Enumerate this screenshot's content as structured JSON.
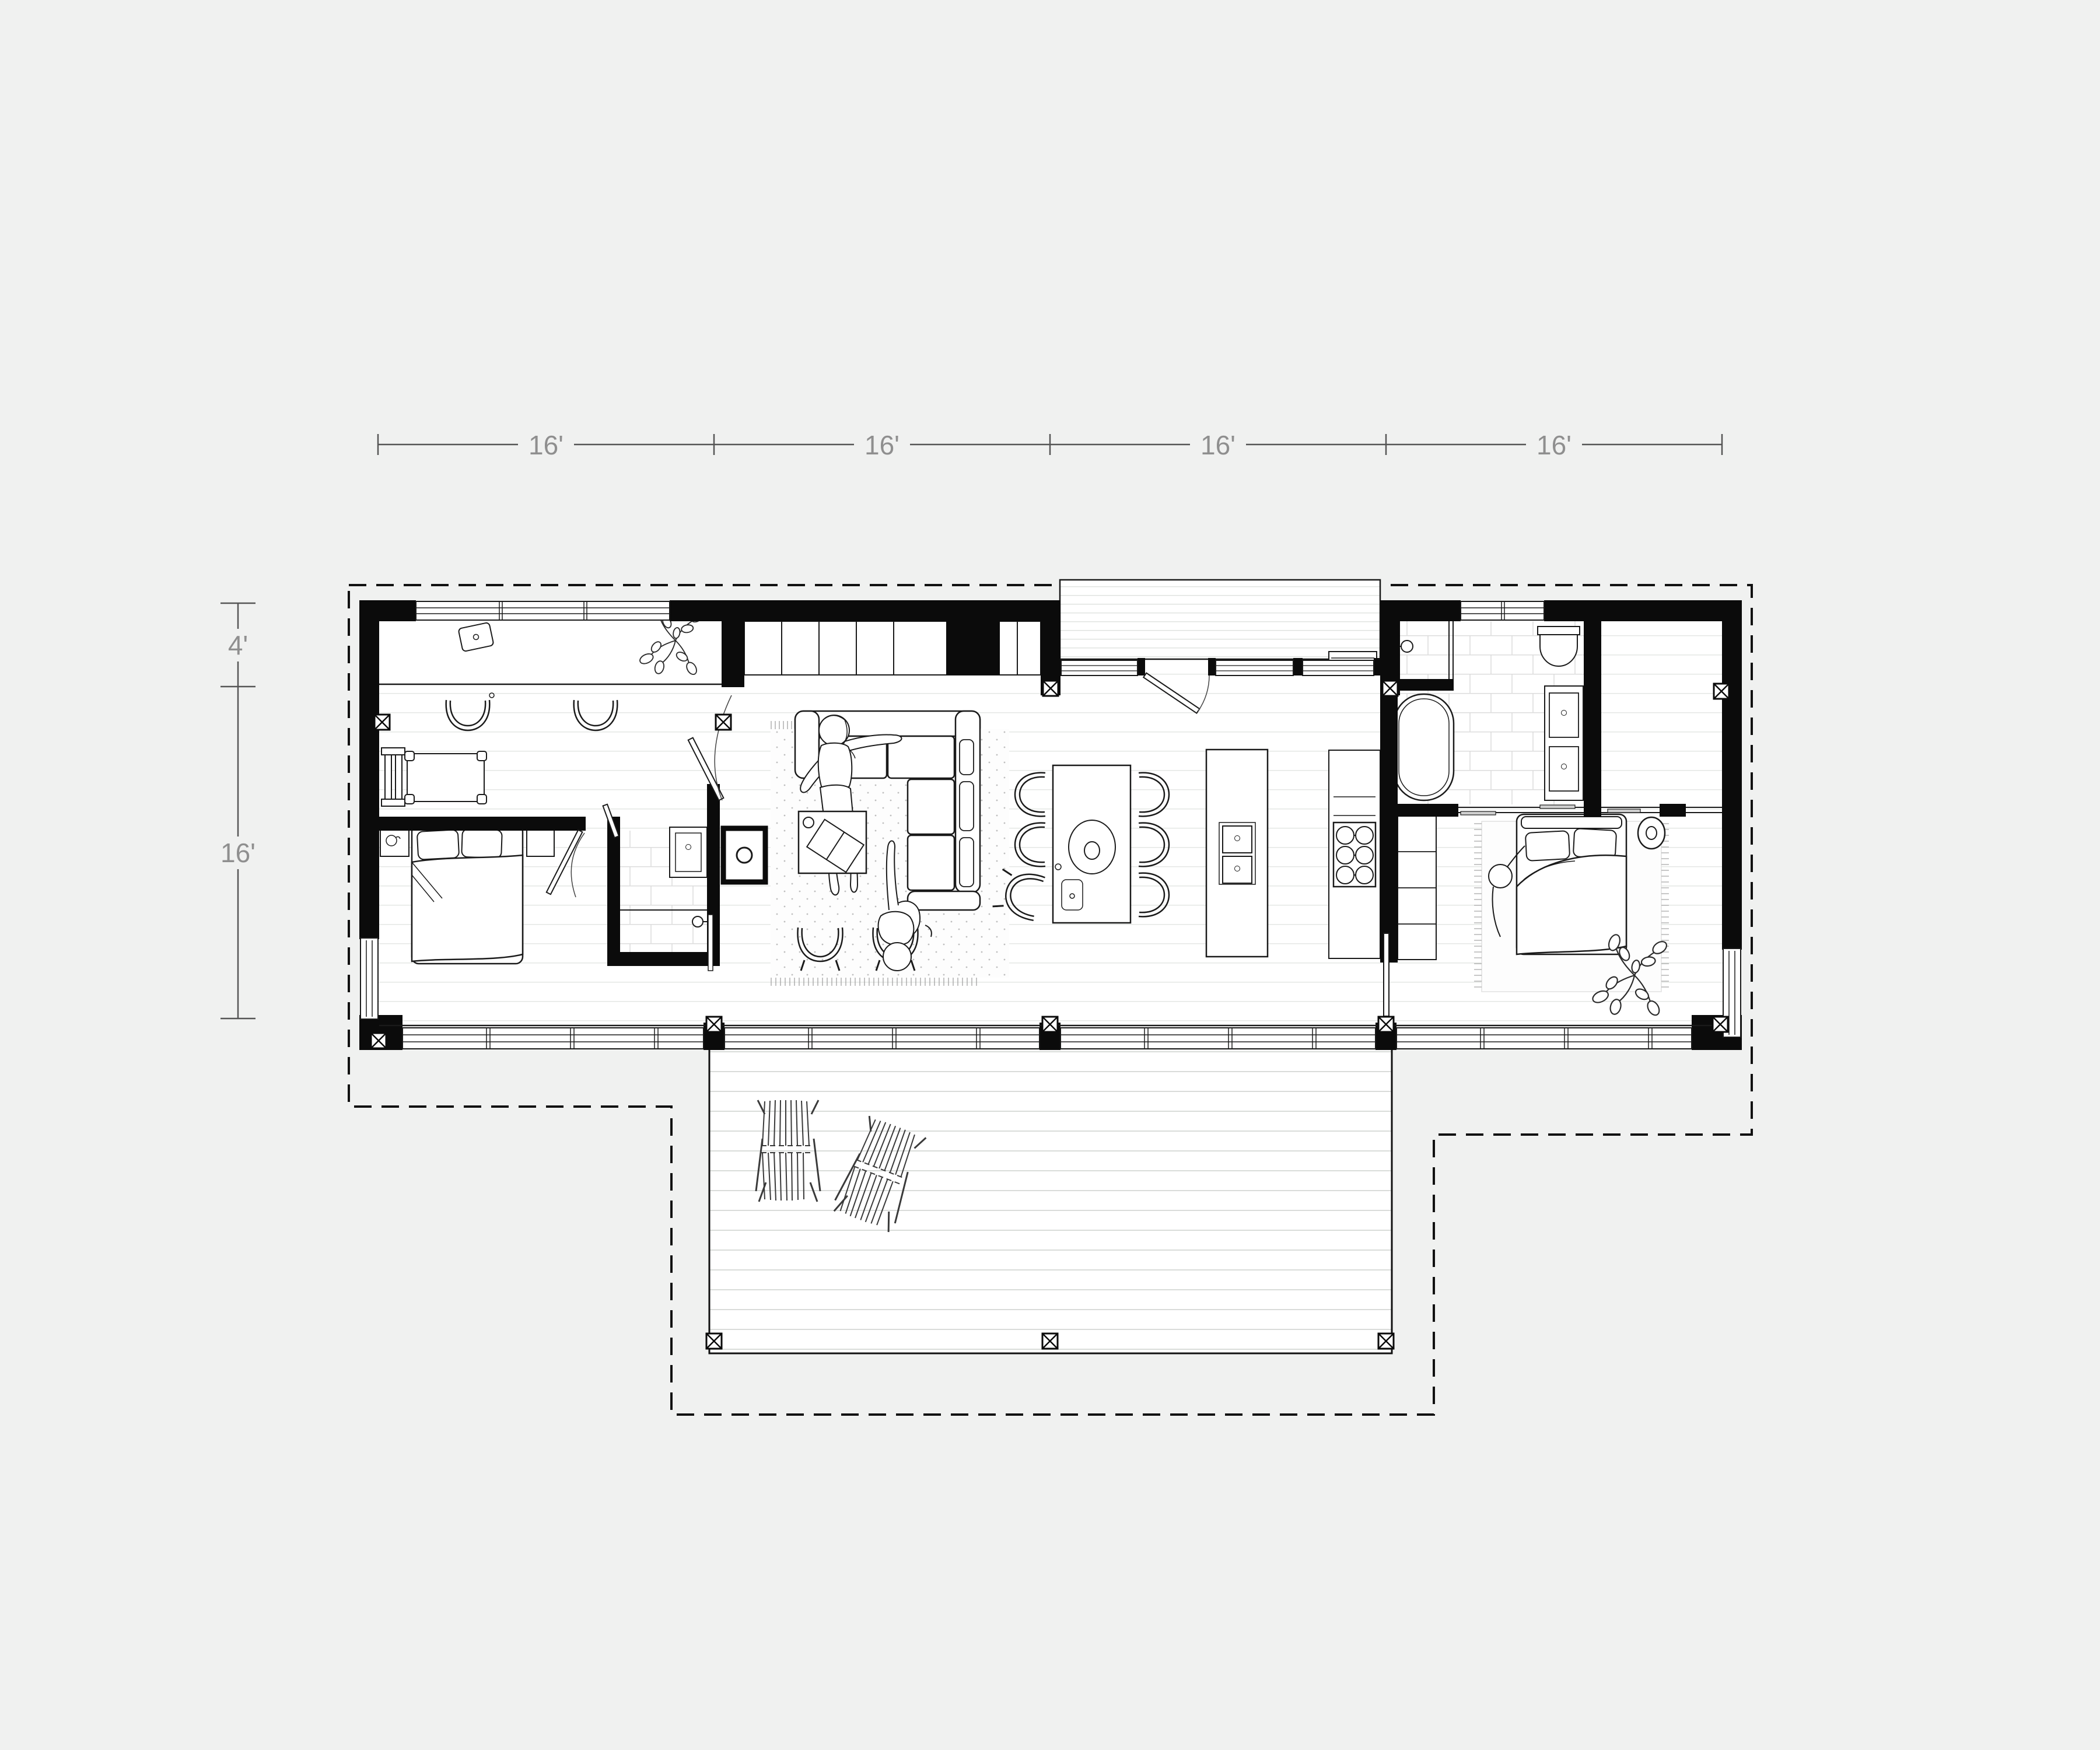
{
  "dimensions": {
    "top": [
      {
        "label": "16'"
      },
      {
        "label": "16'"
      },
      {
        "label": "16'"
      },
      {
        "label": "16'"
      }
    ],
    "left": [
      {
        "label": "4'"
      },
      {
        "label": "16'"
      }
    ]
  },
  "colors": {
    "background": "#f0f1f0",
    "walls": "#0b0b0b",
    "furniture_line": "#1a1a1a",
    "dimension_line": "#555555",
    "dimension_text": "#8f8f8f",
    "plank_line": "#e4e7e4",
    "deck_plank_line": "#d9dcd9",
    "tile_line": "#dcdcdc",
    "rug_dot": "#bfbfbf"
  }
}
